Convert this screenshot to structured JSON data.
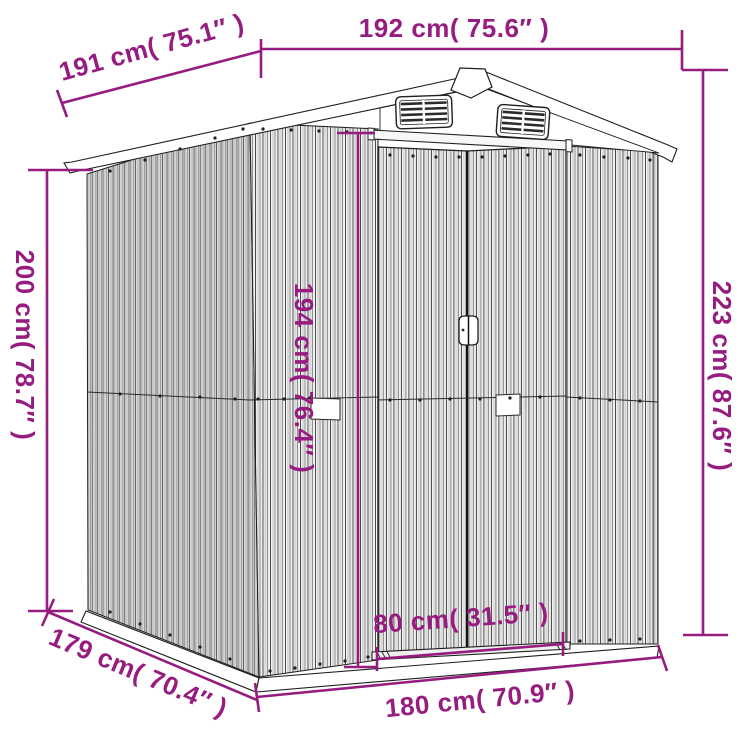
{
  "colors": {
    "dimension_accent": "#971c80",
    "line_art": "#1f1f1f",
    "background": "#ffffff"
  },
  "dimensions": {
    "roof_width_top": "192 cm( 75.6″ )",
    "roof_depth_top": "191 cm( 75.1″ )",
    "wall_height_left": "200 cm( 78.7″ )",
    "total_height_right": "223 cm( 87.6″ )",
    "door_height": "194 cm( 76.4″ )",
    "door_width": "80 cm( 31.5″ )",
    "base_depth_bottom": "179 cm( 70.4″ )",
    "base_width_bottom": "180 cm( 70.9″ )"
  }
}
